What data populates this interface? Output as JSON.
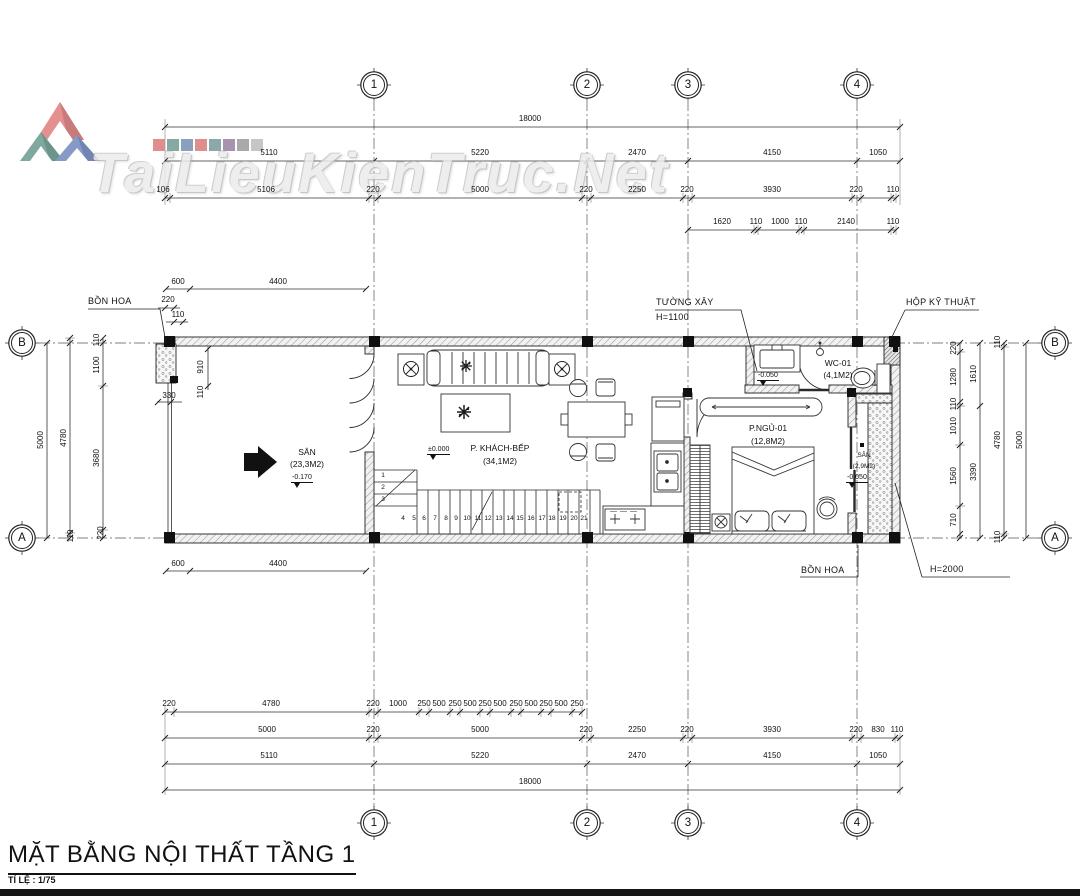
{
  "watermark": {
    "brand": "TaiLieuKienTruc.Net",
    "logo_colors": [
      "#e59090",
      "#7fa89e",
      "#8799c7"
    ],
    "palette": [
      "#df8e8e",
      "#84aaa2",
      "#8aa0bf",
      "#df8e8e",
      "#8ba8ab",
      "#a992ad",
      "#a9a9a9",
      "#c6c6c6"
    ]
  },
  "grid": {
    "cols": [
      "1",
      "2",
      "3",
      "4"
    ],
    "rows": [
      "B",
      "A"
    ]
  },
  "dims": {
    "top": {
      "overall": "18000",
      "main": [
        "5110",
        "5220",
        "2470",
        "4150",
        "1050"
      ],
      "detail": [
        "106",
        "5106",
        "220",
        "5000",
        "220",
        "2250",
        "220",
        "3930",
        "220",
        "110"
      ],
      "sub": [
        "1620",
        "110",
        "1000",
        "110",
        "2140",
        "110"
      ]
    },
    "bottom": {
      "r1": [
        "220",
        "4780",
        "220",
        "1000",
        "250",
        "500",
        "250",
        "500",
        "250",
        "500",
        "250",
        "500",
        "250",
        "500",
        "250"
      ],
      "r2": [
        "5000",
        "220",
        "5000",
        "220",
        "2250",
        "220",
        "3930",
        "220",
        "830",
        "110"
      ],
      "main": [
        "5110",
        "5220",
        "2470",
        "4150",
        "1050"
      ],
      "overall": "18000"
    },
    "left": {
      "outer": "5000",
      "mid": "4780",
      "inner": [
        "110",
        "1100",
        "3680",
        "220"
      ],
      "mid_bottom": "110"
    },
    "right": {
      "inner": [
        "220",
        "1280",
        "110",
        "1010",
        "1560",
        "710"
      ],
      "mid": [
        "1610",
        "3390"
      ],
      "outer": [
        "110",
        "4780",
        "110"
      ],
      "total": "5000"
    },
    "san": {
      "top": [
        "600",
        "4400"
      ],
      "top_small": [
        "220",
        "110"
      ],
      "planter_v": [
        "910",
        "110"
      ],
      "planter_w": "330",
      "bottom": [
        "600",
        "4400"
      ]
    }
  },
  "rooms": [
    {
      "name": "SÂN",
      "area": "(23,3M2)",
      "level": "-0.170"
    },
    {
      "name": "P. KHÁCH-BẾP",
      "area": "(34,1M2)",
      "level": "±0.000"
    },
    {
      "name": "WC-01",
      "area": "(4,1M2)",
      "level": "-0.050"
    },
    {
      "name": "P.NGỦ-01",
      "area": "(12,8M2)",
      "level": ""
    },
    {
      "name": "SÂN",
      "area": "(2,9M2)",
      "level": "-0.050"
    }
  ],
  "annotations": {
    "bon_hoa_top": "BỒN HOA",
    "tuong_xay_1": "TƯỜNG XÂY",
    "tuong_xay_2": "H=1100",
    "hop_ky_thuat": "HỘP KỸ THUẬT",
    "bon_hoa_bottom": "BỒN HOA",
    "h2000": "H=2000"
  },
  "stairs": [
    "1",
    "2",
    "3",
    "4",
    "5",
    "6",
    "7",
    "8",
    "9",
    "10",
    "11",
    "12",
    "13",
    "14",
    "15",
    "16",
    "17",
    "18",
    "19",
    "20",
    "21"
  ],
  "title_block": {
    "title": "MẶT BẰNG NỘI THẤT TẦNG 1",
    "scale": "TỈ LỆ : 1/75"
  }
}
